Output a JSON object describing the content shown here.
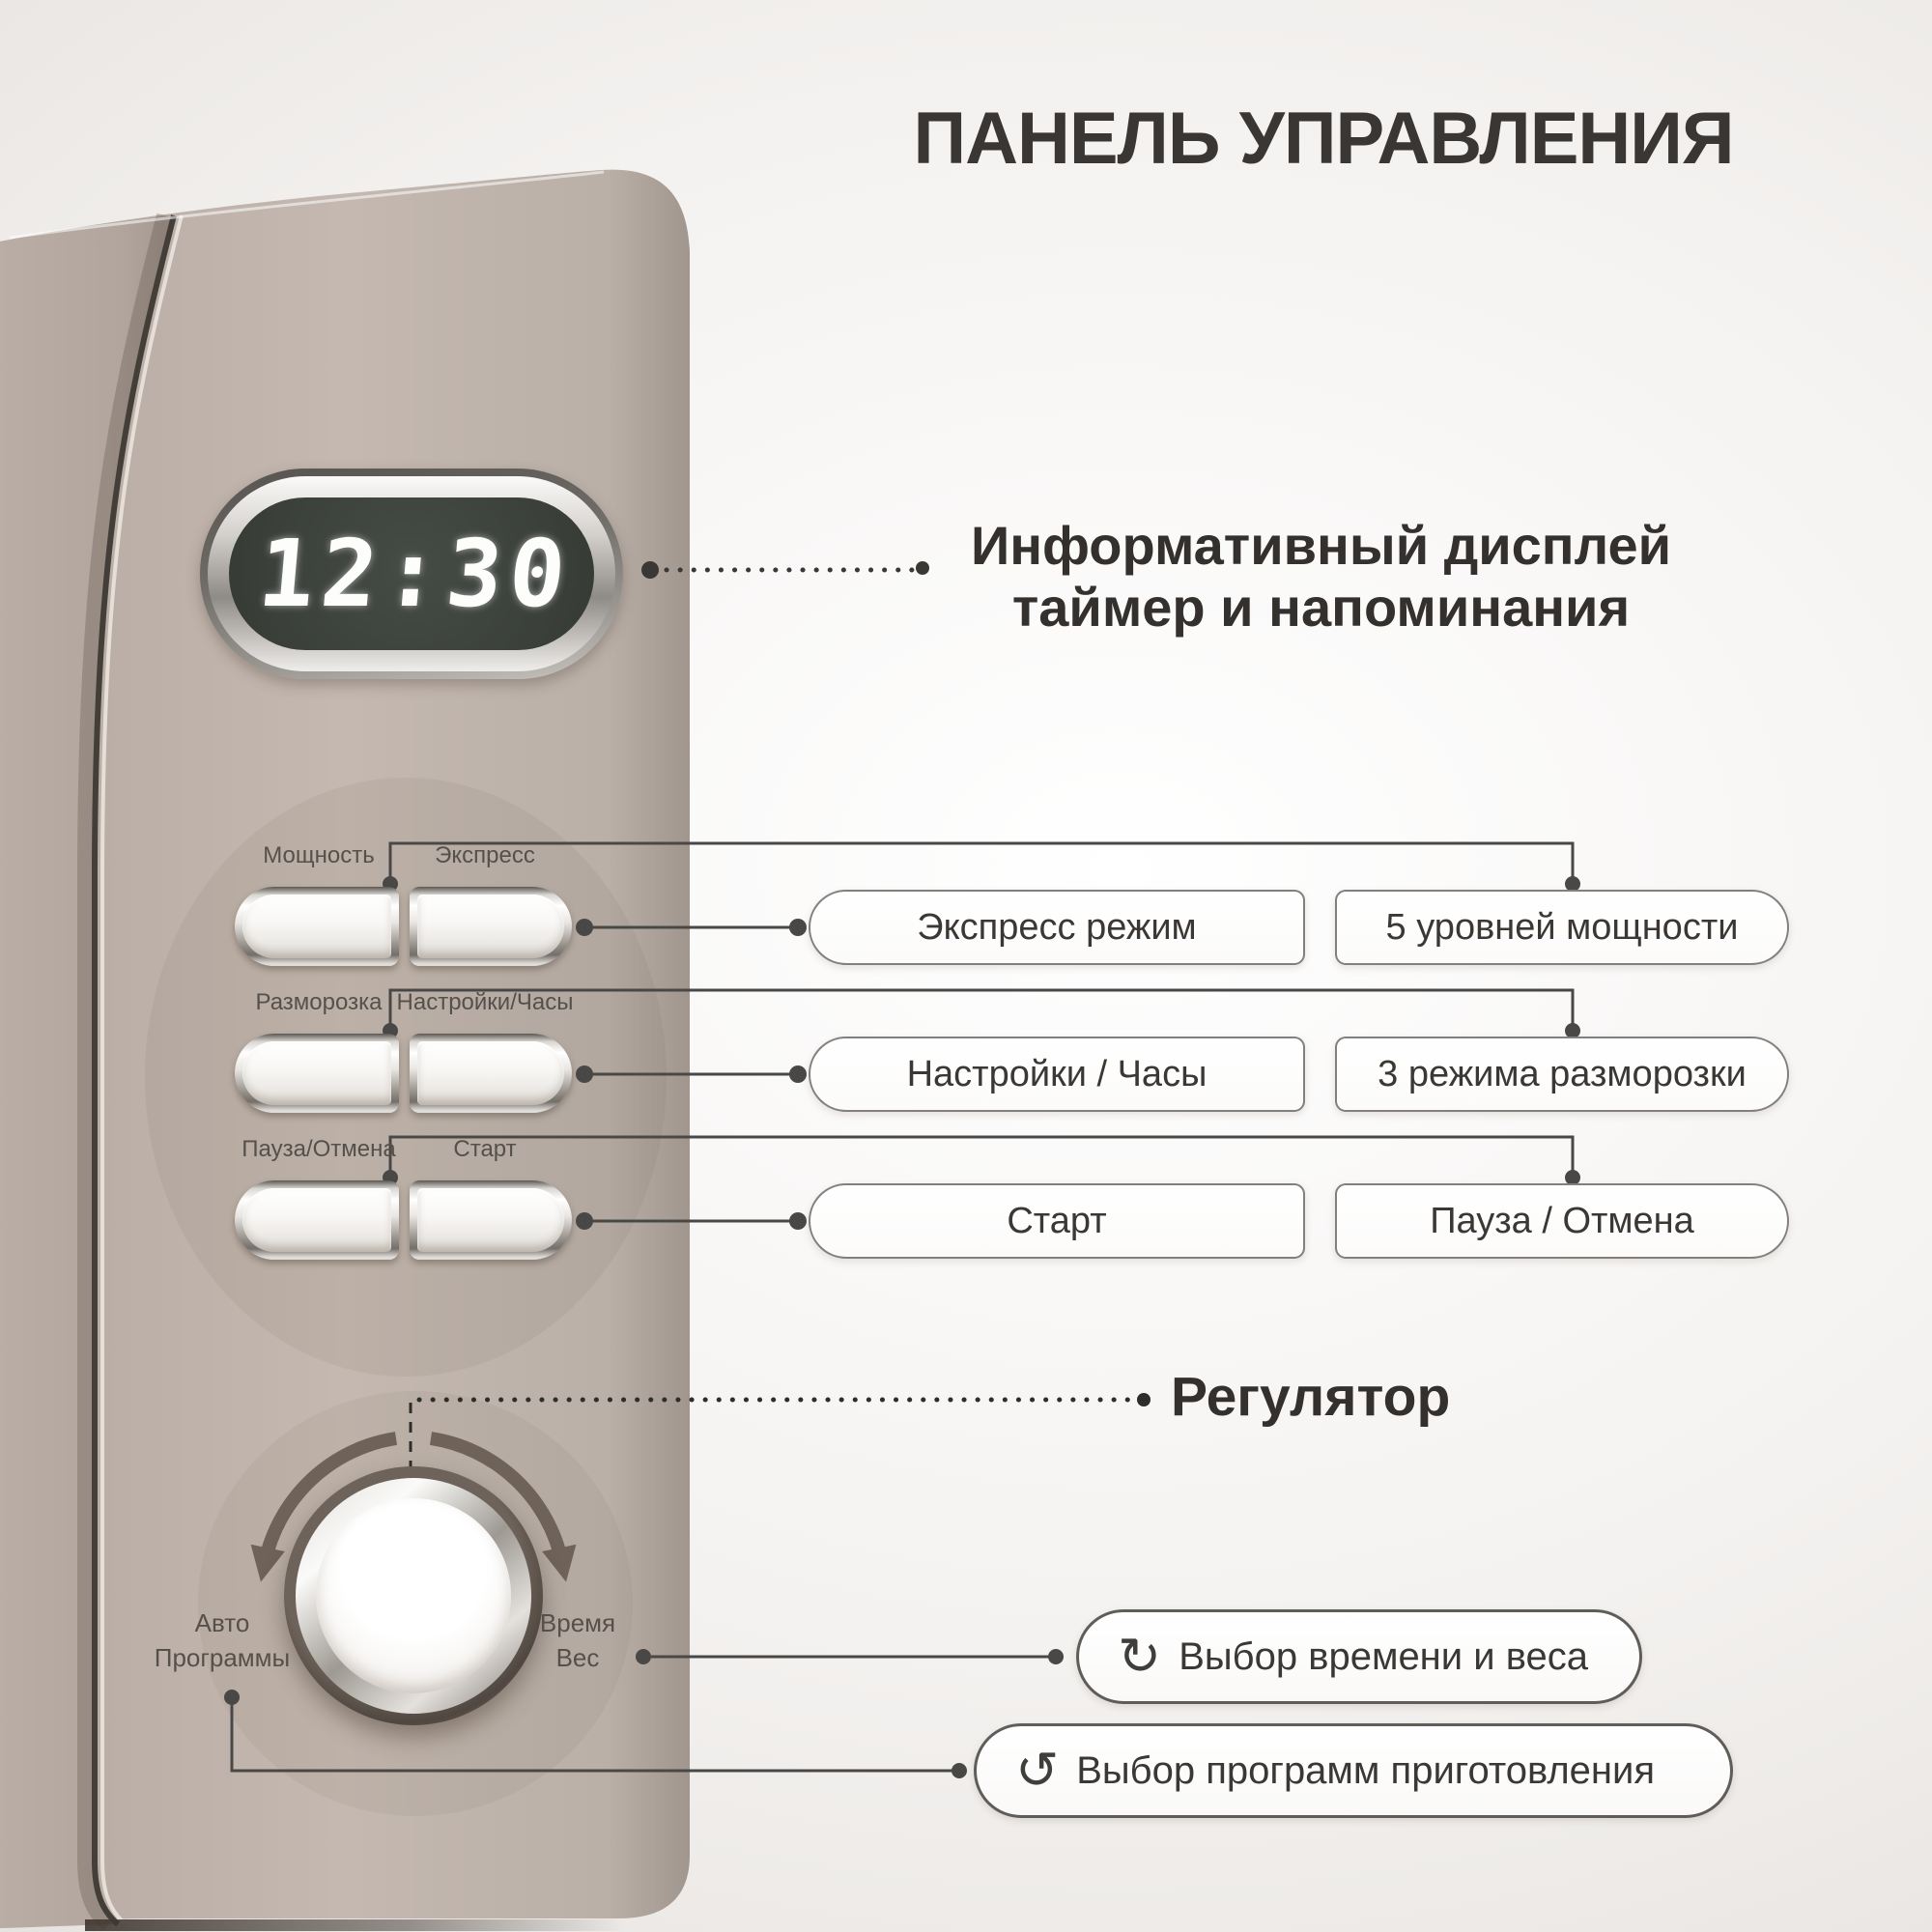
{
  "title": "ПАНЕЛЬ УПРАВЛЕНИЯ",
  "display": {
    "time": "12:30",
    "callout": {
      "line1": "Информативный дисплей",
      "line2": "таймер и напоминания"
    }
  },
  "panel_buttons": [
    {
      "left_label": "Мощность",
      "right_label": "Экспресс"
    },
    {
      "left_label": "Разморозка",
      "right_label": "Настройки/Часы"
    },
    {
      "left_label": "Пауза/Отмена",
      "right_label": "Старт"
    }
  ],
  "callout_boxes": [
    {
      "left": "Экспресс режим",
      "right": "5 уровней мощности"
    },
    {
      "left": "Настройки / Часы",
      "right": "3 режима разморозки"
    },
    {
      "left": "Старт",
      "right": "Пауза / Отмена"
    }
  ],
  "knob": {
    "callout": "Регулятор",
    "left_label": {
      "line1": "Авто",
      "line2": "Программы"
    },
    "right_label": {
      "line1": "Время",
      "line2": "Вес"
    }
  },
  "knob_callouts": [
    {
      "icon": "rotate-cw-icon",
      "glyph": "↻",
      "text": "Выбор времени и веса"
    },
    {
      "icon": "rotate-ccw-icon",
      "glyph": "↺",
      "text": "Выбор программ приготовления"
    }
  ],
  "colors": {
    "panel": "#bfb3ab",
    "screen": "#3b403b",
    "digits": "#ffffff",
    "connector_line": "#4a4846",
    "text_dark": "#37332f"
  }
}
